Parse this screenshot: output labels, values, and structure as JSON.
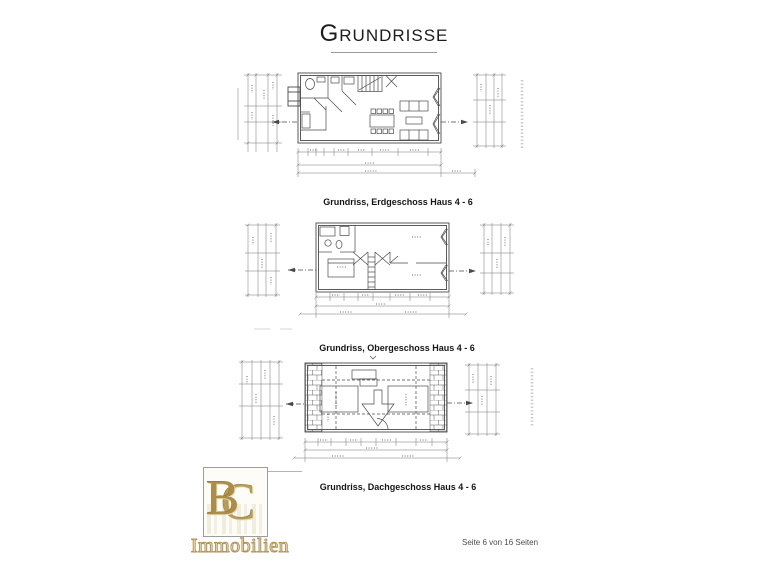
{
  "header": {
    "title": "Grundrisse"
  },
  "floorplans": [
    {
      "caption": "Grundriss, Erdgeschoss Haus 4 - 6"
    },
    {
      "caption": "Grundriss, Obergeschoss Haus 4 - 6"
    },
    {
      "caption": "Grundriss, Dachgeschoss Haus 4 - 6"
    }
  ],
  "logo": {
    "monogram_left": "B",
    "monogram_right": "C",
    "company": "Immobilien"
  },
  "footer": {
    "page_label": "Seite 6 von 16 Seiten"
  },
  "colors": {
    "drawing_line": "#4a4a4a",
    "dimension_line": "#757575",
    "logo_gold": "#b2945a",
    "title_underline": "#9a9a9a"
  }
}
